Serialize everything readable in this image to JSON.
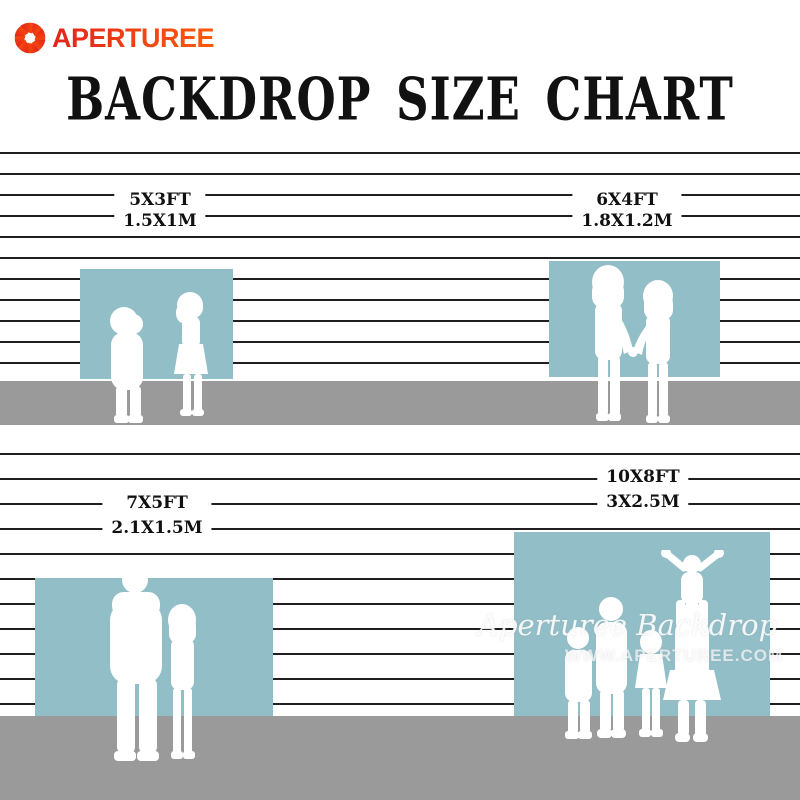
{
  "brand": {
    "name": "APERTUREE",
    "icon": "aperture-icon",
    "color_start": "#e2231a",
    "color_end": "#fd5a07"
  },
  "title": "BACKDROP SIZE CHART",
  "sizes": [
    {
      "ft": "5X3FT",
      "m": "1.5X1M"
    },
    {
      "ft": "6X4FT",
      "m": "1.8X1.2M"
    },
    {
      "ft": "7X5FT",
      "m": "2.1X1.5M"
    },
    {
      "ft": "10X8FT",
      "m": "3X2.5M"
    }
  ],
  "watermark": {
    "line1": "Aperturee Backdrop",
    "line2": "WWW.APERTUREE.COM"
  },
  "colors": {
    "backdrop_blue": "#92bec7",
    "floor_gray": "#9a9a9a",
    "wall_line": "#1f1f1f",
    "text_black": "#111111"
  }
}
